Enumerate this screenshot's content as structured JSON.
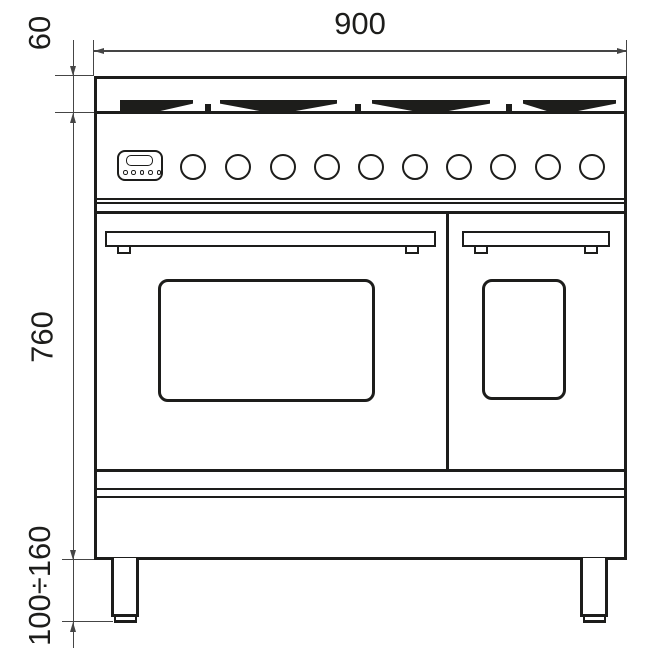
{
  "drawing": {
    "title": "Range cooker front elevation with installation dimensions",
    "ink_color": "#1d1d1b",
    "dimension_line_color": "#454545",
    "background_color": "#ffffff",
    "dimensions": {
      "overall_width": "900",
      "hob_depth": "60",
      "body_height": "760",
      "leg_height_range": "100÷160"
    },
    "hob": {
      "burner_groups": 4
    },
    "control_panel": {
      "knob_count": 10,
      "display_button_count": 5
    },
    "doors": {
      "count": 2
    },
    "legs": {
      "count": 2
    }
  }
}
